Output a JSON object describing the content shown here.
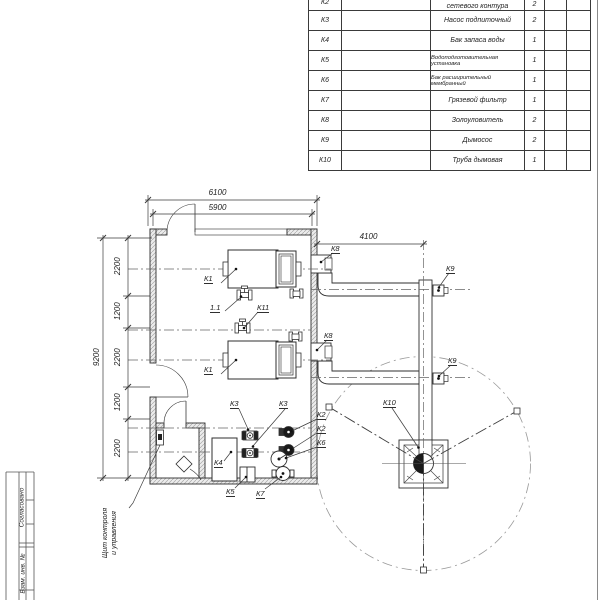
{
  "table": {
    "rows": [
      {
        "pos": "К2",
        "name": "сетевого контура",
        "qty": "2"
      },
      {
        "pos": "К3",
        "name": "Насос подпиточный",
        "qty": "2"
      },
      {
        "pos": "К4",
        "name": "Бак запаса воды",
        "qty": "1"
      },
      {
        "pos": "К5",
        "name": "Водоподготовительная установка",
        "qty": "1"
      },
      {
        "pos": "К6",
        "name": "Бак расширительный мембранный",
        "qty": "1"
      },
      {
        "pos": "К7",
        "name": "Грязевой фильтр",
        "qty": "1"
      },
      {
        "pos": "К8",
        "name": "Золоуловитель",
        "qty": "2"
      },
      {
        "pos": "К9",
        "name": "Дымосос",
        "qty": "2"
      },
      {
        "pos": "К10",
        "name": "Труба дымовая",
        "qty": "1"
      }
    ]
  },
  "dims": {
    "top_outer": "6100",
    "top_inner": "5900",
    "right": "4100",
    "overall": "9200",
    "chain": [
      "2200",
      "1200",
      "2200",
      "1200",
      "2200"
    ]
  },
  "labels": {
    "k1a": "К1",
    "k1b": "К1",
    "v11": "1.1",
    "k11": "К11",
    "k8a": "К8",
    "k8b": "К8",
    "k9a": "К9",
    "k9b": "К9",
    "k10": "К10",
    "k2a": "К2",
    "k2b": "К2",
    "k6": "К6",
    "k3a": "К3",
    "k3b": "К3",
    "k4": "К4",
    "k5": "К5",
    "k7": "К7"
  },
  "annotations": {
    "panel_line1": "Щит контроля",
    "panel_line2": "и управления"
  },
  "stamp": {
    "agreed": "Согласовано",
    "subst": "Взам. инв. №"
  }
}
